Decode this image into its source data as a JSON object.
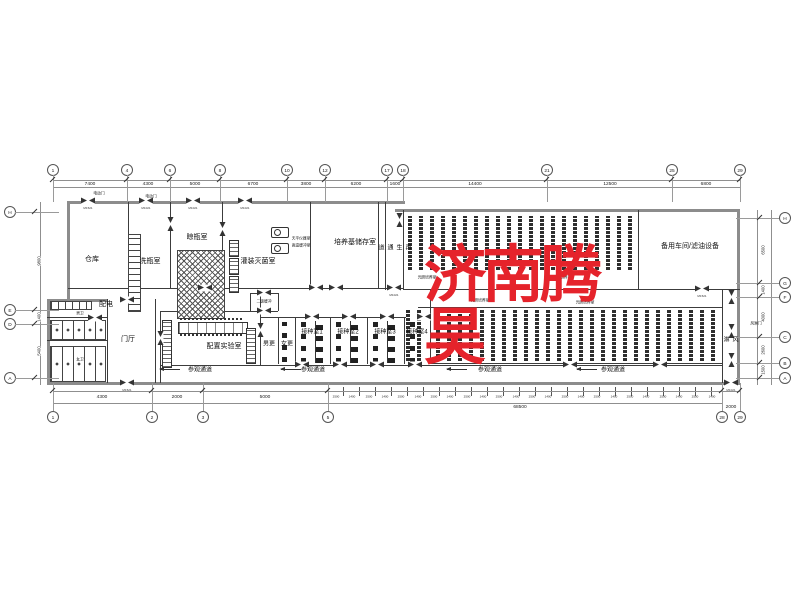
{
  "drawing": {
    "watermark": {
      "text": "济南腾昊",
      "color": "#e5232b"
    },
    "room_labels": [
      {
        "label": "仓库",
        "x": 92,
        "y": 260
      },
      {
        "label": "洗瓶室",
        "x": 150,
        "y": 262
      },
      {
        "label": "晾瓶室",
        "x": 197,
        "y": 238
      },
      {
        "label": "灌装灭菌室",
        "x": 258,
        "y": 262
      },
      {
        "label": "培养基储存室",
        "x": 355,
        "y": 243
      },
      {
        "label": "备用车间/滤油设备",
        "x": 690,
        "y": 247
      },
      {
        "label": "光照培养室",
        "x": 427,
        "y": 278,
        "cls": "xs"
      },
      {
        "label": "光照培养室",
        "x": 562,
        "y": 278,
        "cls": "xs"
      },
      {
        "label": "光照培养室",
        "x": 480,
        "y": 301,
        "cls": "xs"
      },
      {
        "label": "光照培养室",
        "x": 585,
        "y": 303,
        "cls": "xs"
      },
      {
        "label": "配电",
        "x": 106,
        "y": 305
      },
      {
        "label": "男卫",
        "x": 80,
        "y": 314,
        "cls": "xs"
      },
      {
        "label": "女卫",
        "x": 80,
        "y": 360,
        "cls": "xs"
      },
      {
        "label": "门厅",
        "x": 128,
        "y": 340
      },
      {
        "label": "二级缓冲",
        "x": 264,
        "y": 302,
        "cls": "xs"
      },
      {
        "label": "男更",
        "x": 269,
        "y": 345,
        "cls": "sm"
      },
      {
        "label": "女更",
        "x": 287,
        "y": 345,
        "cls": "sm"
      },
      {
        "label": "配置实验室",
        "x": 224,
        "y": 347
      },
      {
        "label": "接种室1",
        "x": 312,
        "y": 333,
        "cls": "sm"
      },
      {
        "label": "接种室2",
        "x": 348,
        "y": 333,
        "cls": "sm"
      },
      {
        "label": "接种室3",
        "x": 385,
        "y": 333,
        "cls": "sm"
      },
      {
        "label": "接种室4",
        "x": 417,
        "y": 333,
        "cls": "sm"
      },
      {
        "label": "参观通道",
        "x": 200,
        "y": 371,
        "cls": "sm"
      },
      {
        "label": "参观通道",
        "x": 313,
        "y": 371,
        "cls": "sm"
      },
      {
        "label": "参观通道",
        "x": 490,
        "y": 371,
        "cls": "sm"
      },
      {
        "label": "参观通道",
        "x": 613,
        "y": 371,
        "cls": "sm"
      }
    ],
    "vertical_labels": [
      {
        "label": "再生通道",
        "x": 394,
        "y": 248
      },
      {
        "label": "风淋",
        "x": 730,
        "y": 340
      }
    ],
    "small_notes": [
      {
        "label": "电动门",
        "x": 99,
        "y": 194
      },
      {
        "label": "电动门",
        "x": 151,
        "y": 197
      },
      {
        "label": "天平仪器室",
        "x": 301,
        "y": 239
      },
      {
        "label": "高温缓冲室",
        "x": 301,
        "y": 246
      },
      {
        "label": "风淋门",
        "x": 756,
        "y": 324
      }
    ],
    "grid": {
      "top": [
        {
          "label": "1",
          "x": 53
        },
        {
          "label": "4",
          "x": 127
        },
        {
          "label": "6",
          "x": 170
        },
        {
          "label": "8",
          "x": 220
        },
        {
          "label": "10",
          "x": 287
        },
        {
          "label": "12",
          "x": 325
        },
        {
          "label": "17",
          "x": 387
        },
        {
          "label": "18",
          "x": 403
        },
        {
          "label": "21",
          "x": 547
        },
        {
          "label": "25",
          "x": 672
        },
        {
          "label": "29",
          "x": 740
        }
      ],
      "bottom": [
        {
          "label": "1",
          "x": 53
        },
        {
          "label": "2",
          "x": 152
        },
        {
          "label": "3",
          "x": 203
        },
        {
          "label": "5",
          "x": 328
        },
        {
          "label": "28",
          "x": 722
        },
        {
          "label": "29",
          "x": 740
        }
      ],
      "left": [
        {
          "label": "H",
          "y": 212
        },
        {
          "label": "E",
          "y": 310
        },
        {
          "label": "D",
          "y": 324
        },
        {
          "label": "A",
          "y": 378
        }
      ],
      "right": [
        {
          "label": "H",
          "y": 218
        },
        {
          "label": "G",
          "y": 283
        },
        {
          "label": "F",
          "y": 297
        },
        {
          "label": "C",
          "y": 337
        },
        {
          "label": "B",
          "y": 363
        },
        {
          "label": "A",
          "y": 378
        }
      ]
    },
    "dims": {
      "top": [
        {
          "label": "7400",
          "x": 90
        },
        {
          "label": "4300",
          "x": 148
        },
        {
          "label": "5000",
          "x": 195
        },
        {
          "label": "6700",
          "x": 253
        },
        {
          "label": "3800",
          "x": 306
        },
        {
          "label": "6200",
          "x": 356
        },
        {
          "label": "1600",
          "x": 395
        },
        {
          "label": "14400",
          "x": 475
        },
        {
          "label": "12500",
          "x": 610
        },
        {
          "label": "6800",
          "x": 706
        }
      ],
      "bottom": [
        {
          "label": "4300",
          "x": 102
        },
        {
          "label": "2000",
          "x": 177
        },
        {
          "label": "5000",
          "x": 265
        }
      ],
      "bottom_chain": [
        {
          "label": "2500",
          "x": 336
        },
        {
          "label": "1400",
          "x": 352
        },
        {
          "label": "2500",
          "x": 369
        },
        {
          "label": "1400",
          "x": 385
        },
        {
          "label": "2500",
          "x": 401
        },
        {
          "label": "1400",
          "x": 418
        },
        {
          "label": "2500",
          "x": 434
        },
        {
          "label": "1400",
          "x": 450
        },
        {
          "label": "2500",
          "x": 467
        },
        {
          "label": "1400",
          "x": 483
        },
        {
          "label": "2500",
          "x": 499
        },
        {
          "label": "1400",
          "x": 516
        },
        {
          "label": "2500",
          "x": 532
        },
        {
          "label": "1400",
          "x": 548
        },
        {
          "label": "2500",
          "x": 565
        },
        {
          "label": "1400",
          "x": 581
        },
        {
          "label": "2500",
          "x": 597
        },
        {
          "label": "1400",
          "x": 614
        },
        {
          "label": "2500",
          "x": 630
        },
        {
          "label": "1400",
          "x": 646
        },
        {
          "label": "2500",
          "x": 663
        },
        {
          "label": "1400",
          "x": 679
        },
        {
          "label": "2500",
          "x": 695
        },
        {
          "label": "1400",
          "x": 712
        }
      ],
      "bottom_totals": [
        {
          "label": "68500",
          "x": 520
        },
        {
          "label": "2000",
          "x": 731
        }
      ],
      "left": [
        {
          "label": "9800",
          "y": 261
        },
        {
          "label": "1400",
          "y": 317
        },
        {
          "label": "5400",
          "y": 351
        }
      ],
      "right": [
        {
          "label": "6500",
          "y": 250
        },
        {
          "label": "1400",
          "y": 290
        },
        {
          "label": "4000",
          "y": 317
        },
        {
          "label": "2600",
          "y": 350
        },
        {
          "label": "1500",
          "y": 370
        }
      ]
    },
    "doors": [
      {
        "x": 88,
        "y": 201,
        "cls": "dh",
        "tag": "M1521"
      },
      {
        "x": 146,
        "y": 201,
        "cls": "dh",
        "tag": "M1021"
      },
      {
        "x": 193,
        "y": 201,
        "cls": "dh",
        "tag": "M1021"
      },
      {
        "x": 245,
        "y": 201,
        "cls": "dh",
        "tag": "M1021"
      },
      {
        "x": 170,
        "y": 224,
        "cls": "dv"
      },
      {
        "x": 222,
        "y": 229,
        "cls": "dv"
      },
      {
        "x": 399,
        "y": 220,
        "cls": "dv"
      },
      {
        "x": 394,
        "y": 288,
        "cls": "dh",
        "tag": "M1021"
      },
      {
        "x": 702,
        "y": 289,
        "cls": "dh",
        "tag": "M1521"
      },
      {
        "x": 205,
        "y": 288,
        "cls": "dh"
      },
      {
        "x": 316,
        "y": 288,
        "cls": "dh"
      },
      {
        "x": 336,
        "y": 288,
        "cls": "dh"
      },
      {
        "x": 127,
        "y": 300,
        "cls": "dh"
      },
      {
        "x": 127,
        "y": 383,
        "cls": "dh",
        "tag": "M1521"
      },
      {
        "x": 95,
        "y": 318,
        "cls": "dh"
      },
      {
        "x": 160,
        "y": 338,
        "cls": "dv"
      },
      {
        "x": 260,
        "y": 330,
        "cls": "dv"
      },
      {
        "x": 264,
        "y": 293,
        "cls": "dh"
      },
      {
        "x": 264,
        "y": 311,
        "cls": "dh"
      },
      {
        "x": 312,
        "y": 317,
        "cls": "dh"
      },
      {
        "x": 349,
        "y": 317,
        "cls": "dh"
      },
      {
        "x": 387,
        "y": 317,
        "cls": "dh"
      },
      {
        "x": 424,
        "y": 317,
        "cls": "dh"
      },
      {
        "x": 302,
        "y": 365,
        "cls": "dh"
      },
      {
        "x": 340,
        "y": 365,
        "cls": "dh"
      },
      {
        "x": 377,
        "y": 365,
        "cls": "dh"
      },
      {
        "x": 415,
        "y": 365,
        "cls": "dh"
      },
      {
        "x": 570,
        "y": 365,
        "cls": "dh"
      },
      {
        "x": 660,
        "y": 365,
        "cls": "dh"
      },
      {
        "x": 731,
        "y": 297,
        "cls": "dv"
      },
      {
        "x": 731,
        "y": 331,
        "cls": "dv"
      },
      {
        "x": 731,
        "y": 360,
        "cls": "dv"
      },
      {
        "x": 731,
        "y": 383,
        "cls": "dh",
        "tag": "M1021"
      }
    ]
  }
}
